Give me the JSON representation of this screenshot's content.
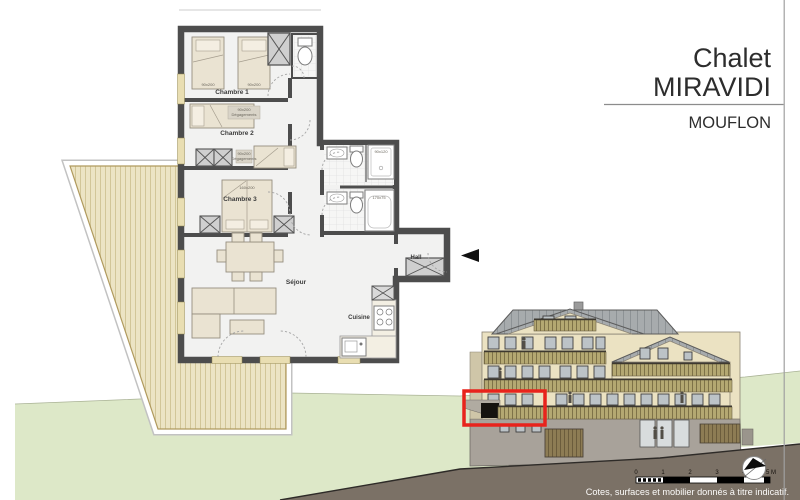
{
  "title_block": {
    "project_name_line1": "Chalet",
    "project_name_line2": "MIRAVIDI",
    "unit_name": "MOUFLON"
  },
  "floor_plan": {
    "rooms": [
      {
        "label": "Chambre 1"
      },
      {
        "label": "Chambre 2"
      },
      {
        "label": "Chambre 3"
      },
      {
        "label": "Séjour"
      },
      {
        "label": "Cuisine"
      },
      {
        "label": "Hall"
      }
    ],
    "dimension_labels": {
      "bed_single_1": "90x200",
      "bed_single_2": "90x200",
      "note_1_line1": "90x200",
      "note_1_line2": "Dégagements",
      "note_2_line1": "90x200",
      "note_2_line2": "Dégagements",
      "bed_double": "160x200",
      "shower": "90x120",
      "bathtub": "170x75"
    }
  },
  "elevation": {
    "highlight_color": "#e8231c"
  },
  "scale_bar": {
    "labels": [
      "0",
      "1",
      "2",
      "3",
      "4",
      "5 M"
    ]
  },
  "compass": {
    "icon": "north-arrow"
  },
  "footer": {
    "disclaimer": "Cotes, surfaces et mobilier donnés à titre indicatif."
  },
  "colors": {
    "wall": "#4d4d4d",
    "terrace_wood": "#ece4c4",
    "terrain_green": "#dde8c8",
    "soil": "#7b7166",
    "facade": "#ebe2c2",
    "roof": "#a7abad",
    "balcony_wood": "#b6aa72",
    "highlight_red": "#e8231c"
  }
}
